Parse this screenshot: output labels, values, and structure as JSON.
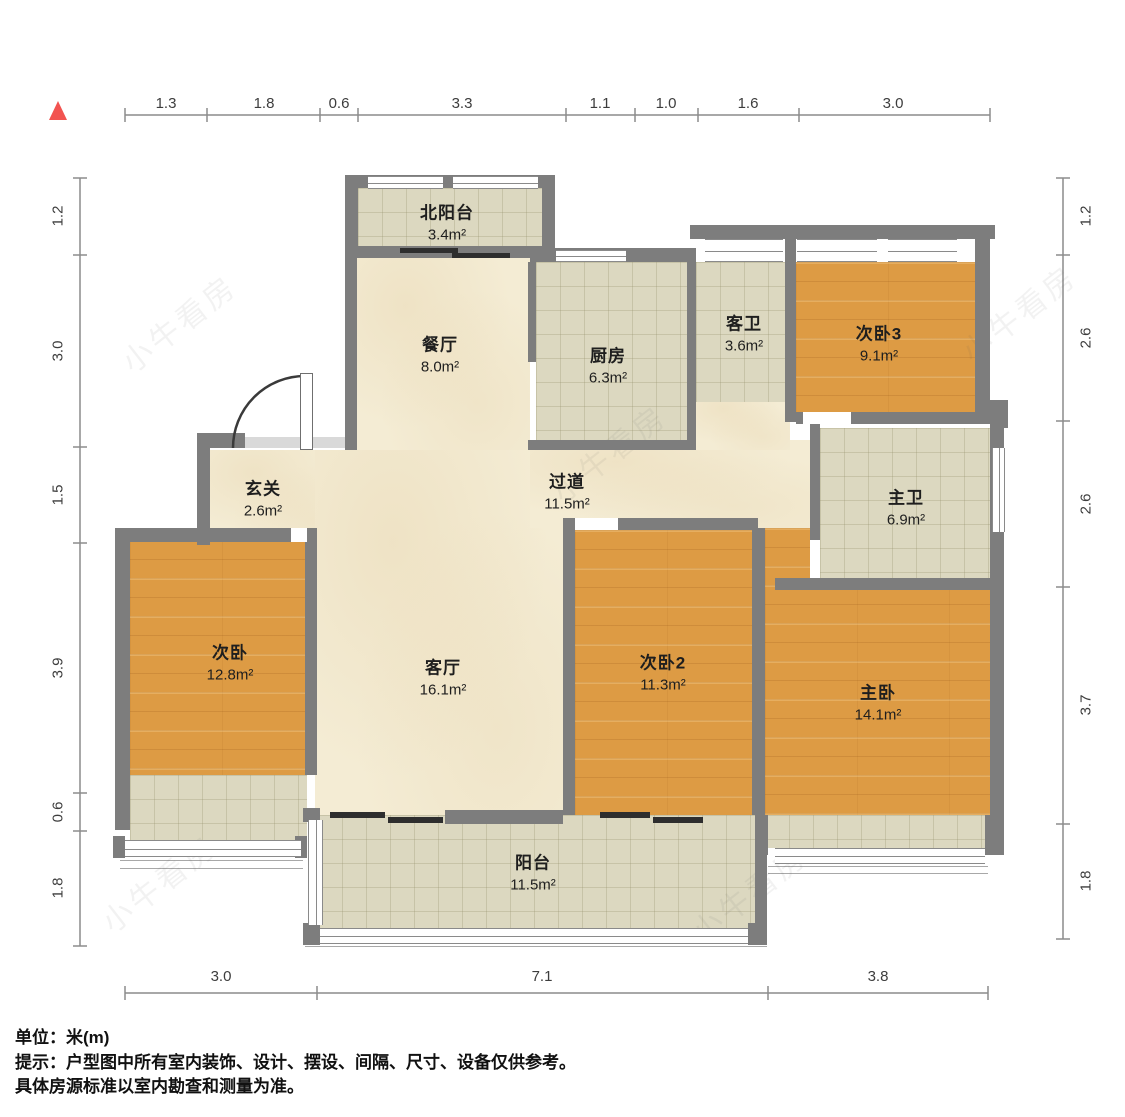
{
  "rooms": [
    {
      "id": "north-balcony",
      "name": "北阳台",
      "area": "3.4m²"
    },
    {
      "id": "dining",
      "name": "餐厅",
      "area": "8.0m²"
    },
    {
      "id": "kitchen",
      "name": "厨房",
      "area": "6.3m²"
    },
    {
      "id": "guest-bath",
      "name": "客卫",
      "area": "3.6m²"
    },
    {
      "id": "bedroom3",
      "name": "次卧3",
      "area": "9.1m²"
    },
    {
      "id": "foyer",
      "name": "玄关",
      "area": "2.6m²"
    },
    {
      "id": "hallway",
      "name": "过道",
      "area": "11.5m²"
    },
    {
      "id": "master-bath",
      "name": "主卫",
      "area": "6.9m²"
    },
    {
      "id": "bedroom",
      "name": "次卧",
      "area": "12.8m²"
    },
    {
      "id": "living",
      "name": "客厅",
      "area": "16.1m²"
    },
    {
      "id": "bedroom2",
      "name": "次卧2",
      "area": "11.3m²"
    },
    {
      "id": "master-bedroom",
      "name": "主卧",
      "area": "14.1m²"
    },
    {
      "id": "balcony",
      "name": "阳台",
      "area": "11.5m²"
    }
  ],
  "dims": {
    "top": [
      "1.3",
      "1.8",
      "0.6",
      "3.3",
      "1.1",
      "1.0",
      "1.6",
      "3.0"
    ],
    "left": [
      "1.2",
      "3.0",
      "1.5",
      "3.9",
      "0.6",
      "1.8"
    ],
    "right": [
      "1.2",
      "2.6",
      "2.6",
      "3.7",
      "1.8"
    ],
    "bottom": [
      "3.0",
      "7.1",
      "3.8"
    ]
  },
  "notes": {
    "unit": "单位：米(m)",
    "tip": "提示：户型图中所有室内装饰、设计、摆设、间隔、尺寸、设备仅供参考。",
    "tip2": "具体房源标准以室内勘查和测量为准。"
  },
  "watermark": "小牛看房"
}
